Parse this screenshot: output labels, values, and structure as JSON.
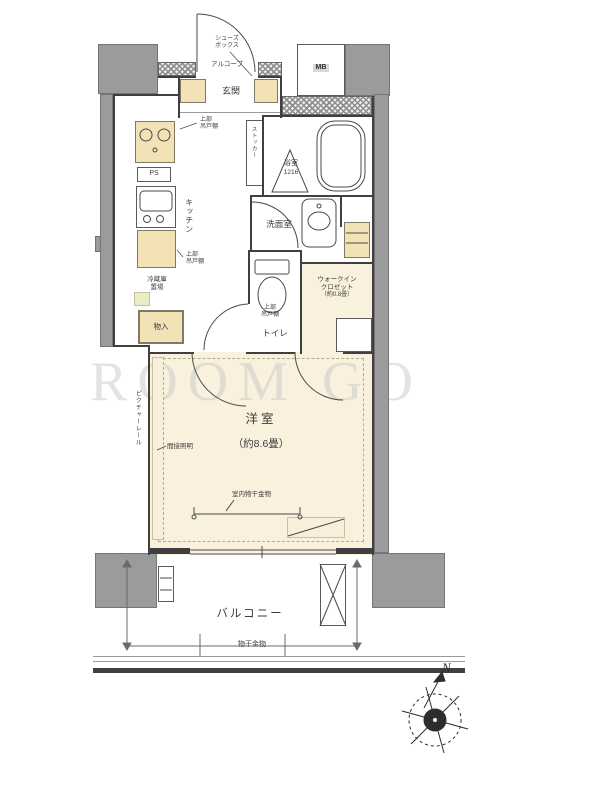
{
  "watermark": "ROOM GO",
  "compass": {
    "north": "N"
  },
  "entrance": {
    "label": "玄関",
    "alcove": "アルコーブ",
    "shoes_line1": "シューズ",
    "shoes_line2": "ボックス",
    "meter_box": "MB"
  },
  "kitchen": {
    "label": "キッチン",
    "ps": "PS",
    "upper_cabinet_line1": "上部",
    "upper_cabinet_line2": "吊戸棚",
    "fridge_line1": "冷蔵庫",
    "fridge_line2": "置場",
    "storage": "物入"
  },
  "bath": {
    "label": "浴室",
    "size": "1216",
    "stocker": "ストッカー"
  },
  "washroom": {
    "label": "洗面室"
  },
  "toilet": {
    "label": "トイレ",
    "upper_cabinet_line1": "上部",
    "upper_cabinet_line2": "吊戸棚"
  },
  "wic": {
    "line1": "ウォークイン",
    "line2": "クロゼット",
    "size": "（約0.8畳）"
  },
  "bedroom": {
    "label": "洋室",
    "size": "（約8.6畳）",
    "indirect_light": "間接照明",
    "picture_rail": "ピクチャーレール",
    "indoor_hanger": "室内物干金物"
  },
  "balcony": {
    "label": "バルコニー",
    "hanger": "物干金物"
  }
}
